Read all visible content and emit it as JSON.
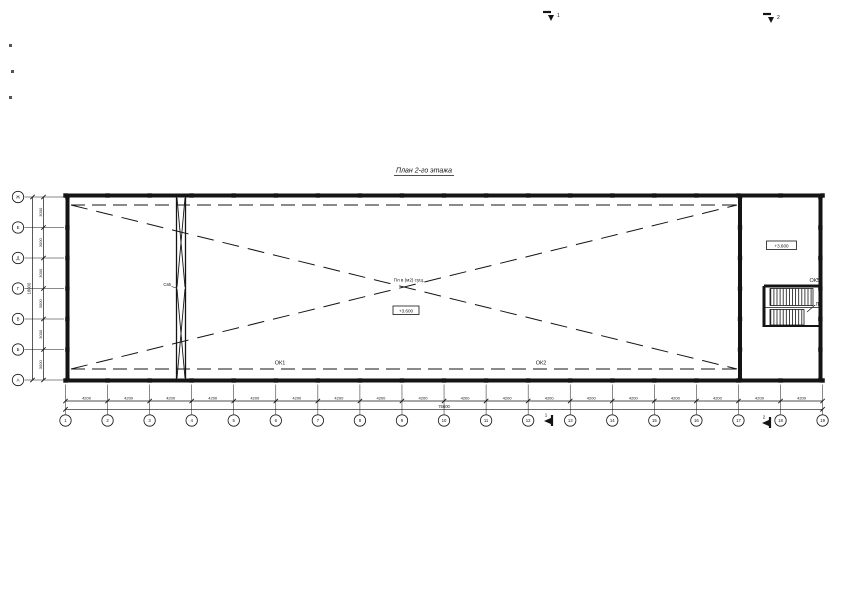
{
  "page": {
    "background": "#ffffff",
    "ink": "#141414"
  },
  "title": {
    "text": "План 2-го этажа"
  },
  "axes": {
    "bottom_labels": [
      "1",
      "2",
      "3",
      "4",
      "5",
      "6",
      "7",
      "8",
      "9",
      "10",
      "11",
      "12",
      "13",
      "14",
      "15",
      "16",
      "17",
      "18",
      "19"
    ],
    "left_labels_top_to_bottom": [
      "Ж",
      "Е",
      "Д",
      "Г",
      "В",
      "Б",
      "А"
    ]
  },
  "dims": {
    "bottom_segment_labels": [
      "4200",
      "4200",
      "4200",
      "4200",
      "4200",
      "4200",
      "4200",
      "4200",
      "4200",
      "4200",
      "4200",
      "4200",
      "4200",
      "4200",
      "4200",
      "4200",
      "4200",
      "4200"
    ],
    "bottom_total_label": "75600",
    "left_segment_labels": [
      "3000",
      "3000",
      "3000",
      "3000",
      "3000",
      "3000"
    ],
    "left_total_label": "18000"
  },
  "annotations": {
    "ok1": "ОК1",
    "ok2": "ОК2",
    "ok5": "ОК5",
    "stair_label": "Л2",
    "bracing_label": "Св5",
    "center_note": "Пл в (м2) сущ.",
    "center_level": "+3.600",
    "stair_level": "+3.600",
    "section_marks": [
      {
        "label": "1"
      },
      {
        "label": "2"
      },
      {
        "label": "1"
      },
      {
        "label": "2"
      }
    ]
  }
}
